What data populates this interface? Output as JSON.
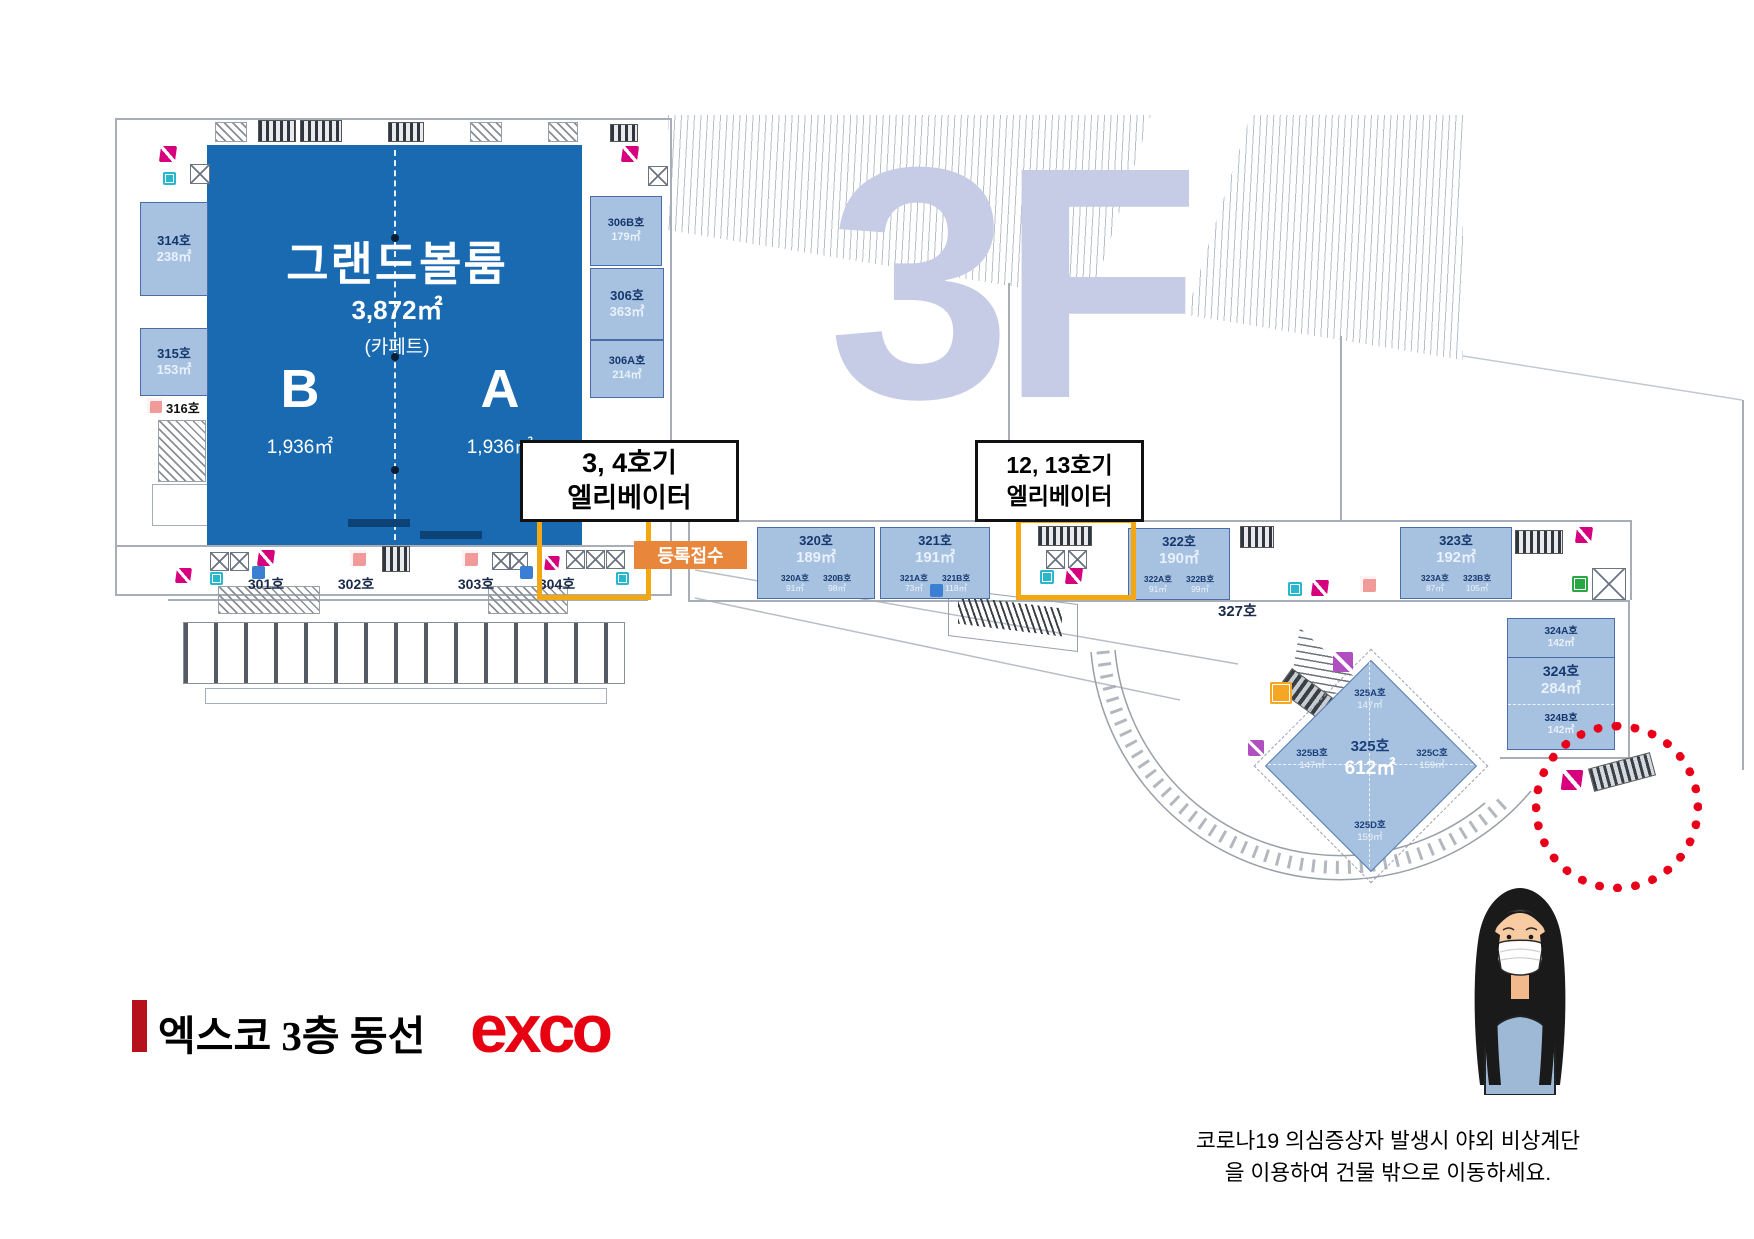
{
  "floor_watermark": "3F",
  "ballroom": {
    "name": "그랜드볼룸",
    "area": "3,872㎡",
    "note": "(카페트)",
    "section_b": {
      "label": "B",
      "area": "1,936㎡"
    },
    "section_a": {
      "label": "A",
      "area": "1,936㎡"
    }
  },
  "rooms": {
    "r314": {
      "name": "314호",
      "area": "238㎡"
    },
    "r315": {
      "name": "315호",
      "area": "153㎡"
    },
    "r316": {
      "name": "316호"
    },
    "r306b": {
      "name": "306B호",
      "area": "179㎡"
    },
    "r306": {
      "name": "306호",
      "area": "363㎡"
    },
    "r306a": {
      "name": "306A호",
      "area": "214㎡"
    },
    "r301": {
      "name": "301호"
    },
    "r302": {
      "name": "302호"
    },
    "r303": {
      "name": "303호"
    },
    "r304": {
      "name": "304호"
    },
    "r327": {
      "name": "327호"
    }
  },
  "band_rooms": [
    {
      "name": "320호",
      "area": "189㎡",
      "subs": [
        {
          "name": "320A호",
          "area": "91㎡"
        },
        {
          "name": "320B호",
          "area": "98㎡"
        }
      ]
    },
    {
      "name": "321호",
      "area": "191㎡",
      "subs": [
        {
          "name": "321A호",
          "area": "73㎡"
        },
        {
          "name": "321B호",
          "area": "118㎡"
        }
      ]
    },
    {
      "name": "322호",
      "area": "190㎡",
      "subs": [
        {
          "name": "322A호",
          "area": "91㎡"
        },
        {
          "name": "322B호",
          "area": "99㎡"
        }
      ]
    },
    {
      "name": "323호",
      "area": "192㎡",
      "subs": [
        {
          "name": "323A호",
          "area": "87㎡"
        },
        {
          "name": "323B호",
          "area": "105㎡"
        }
      ]
    }
  ],
  "r324": {
    "top_name": "324A호",
    "top_area": "142㎡",
    "name": "324호",
    "area": "284㎡",
    "bottom_name": "324B호",
    "bottom_area": "142㎡"
  },
  "r325": {
    "name": "325호",
    "area": "612㎡",
    "a_name": "325A호",
    "a_area": "147㎡",
    "b_name": "325B호",
    "b_area": "147㎡",
    "c_name": "325C호",
    "c_area": "159㎡",
    "d_name": "325D호",
    "d_area": "159㎡"
  },
  "callout_elevator_34": {
    "line1": "3, 4호기",
    "line2": "엘리베이터"
  },
  "callout_elevator_1213": {
    "line1": "12, 13호기",
    "line2": "엘리베이터"
  },
  "registration": {
    "label": "등록접수"
  },
  "footer": {
    "title": "엑스코 3층 동선",
    "logo": "exco"
  },
  "notice": {
    "line1": "코로나19 의심증상자 발생시 야외 비상계단",
    "line2": "을 이용하여 건물 밖으로 이동하세요."
  },
  "colors": {
    "ballroom_blue": "#1a6ab2",
    "room_blue": "#a7c1e0",
    "highlight_orange": "#f3a812",
    "registration_orange": "#e8873c",
    "exco_red": "#e60012",
    "watermark_blue": "#c7cce6",
    "dotted_circle_red": "#e8001b"
  }
}
